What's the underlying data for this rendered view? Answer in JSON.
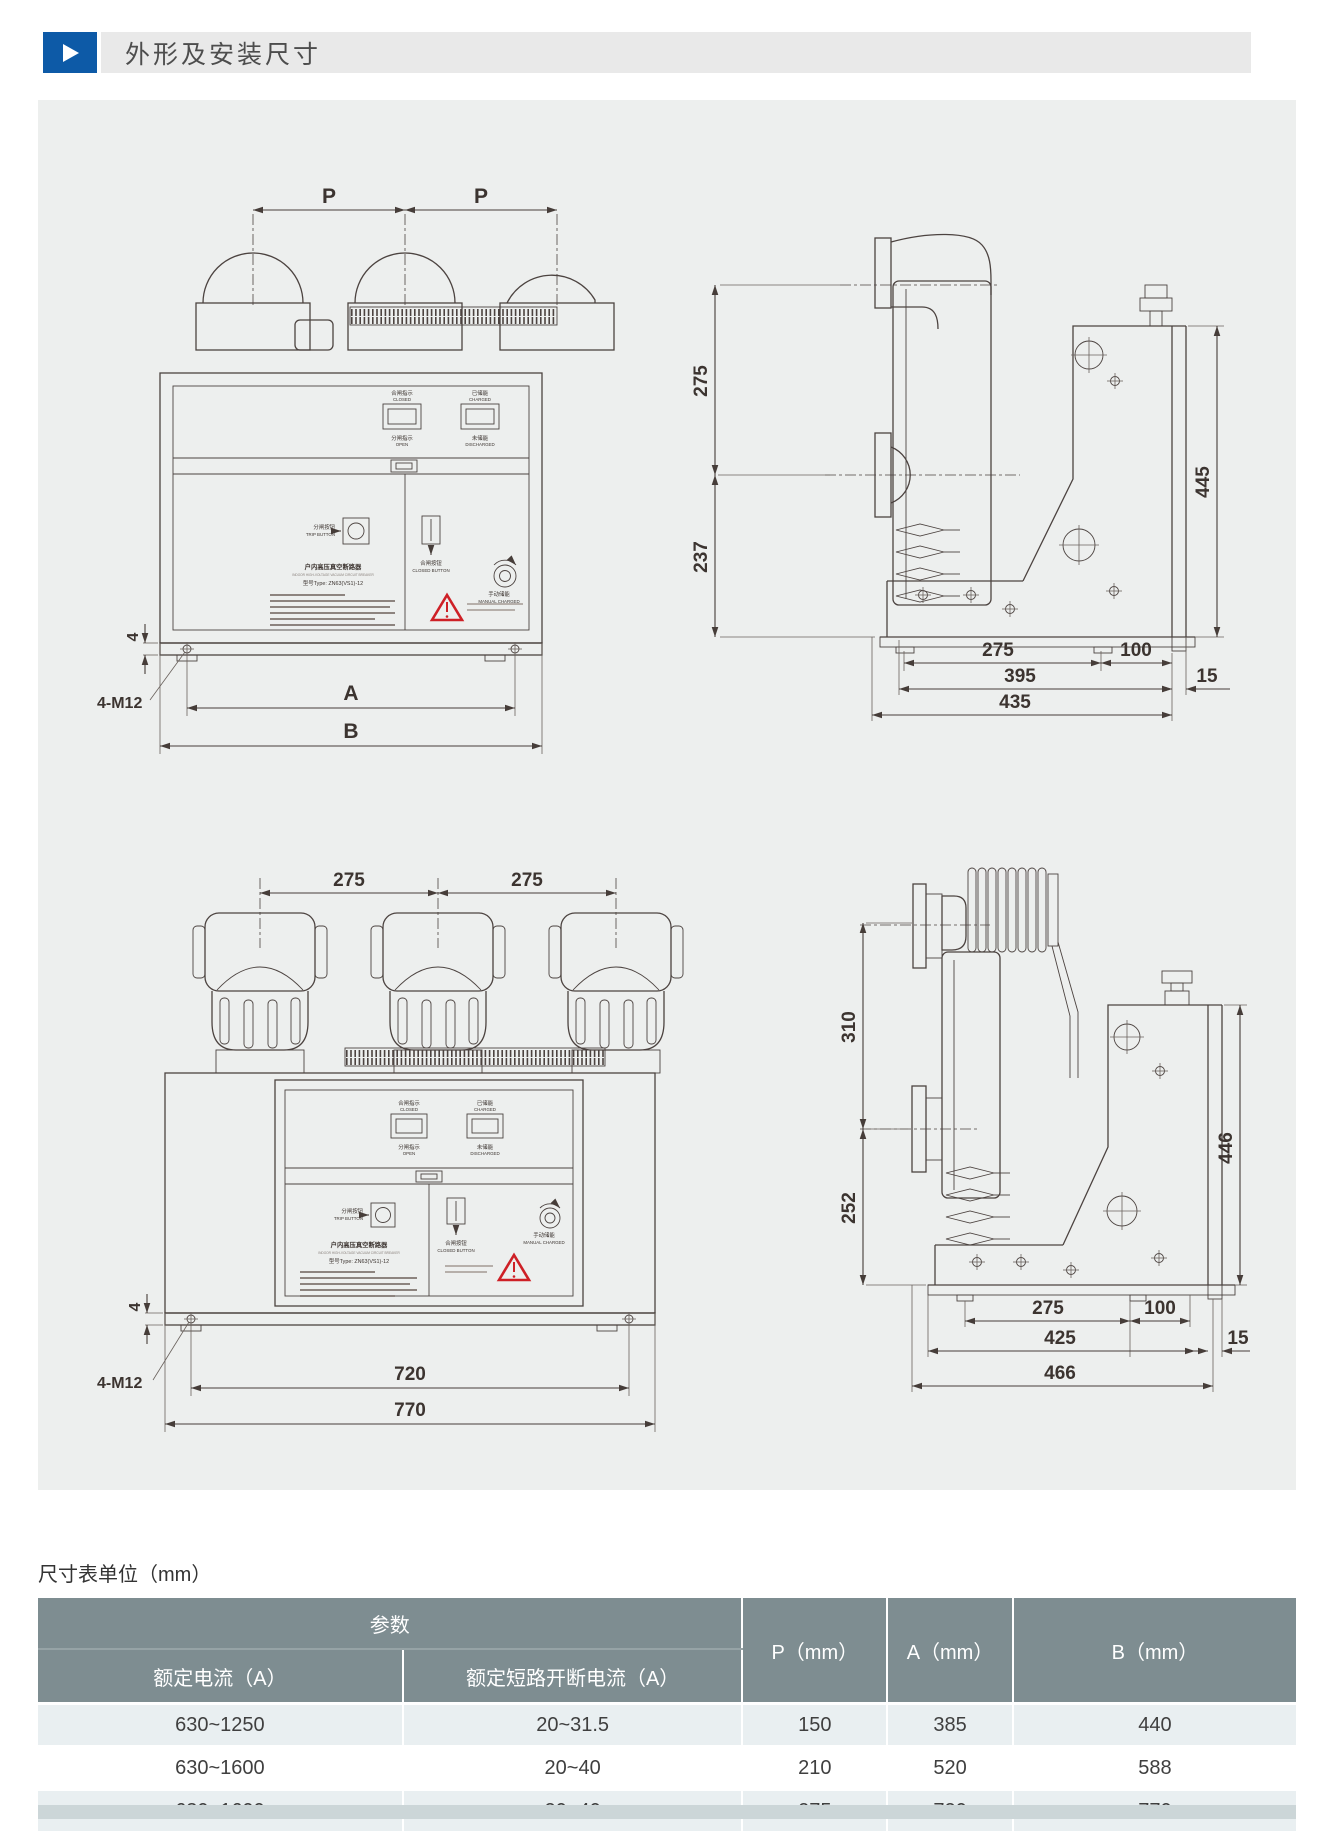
{
  "colors": {
    "accent_blue": "#0d5aa7",
    "title_bar_bg": "#e9e9e9",
    "panel_bg": "#edefee",
    "table_header_bg": "#7e8d91",
    "row_alt_bg": "#e9eff1",
    "warning_red": "#ce2026",
    "drawing_line": "#4c4340"
  },
  "header": {
    "title": "外形及安装尺寸"
  },
  "drawings": {
    "panel_labels": {
      "closed_cn": "合闸指示",
      "closed_en": "CLOSED",
      "charged_cn": "已储能",
      "charged_en": "CHARGED",
      "open_cn": "分闸指示",
      "open_en": "OPEN",
      "discharged_cn": "未储能",
      "discharged_en": "DISCHARGED",
      "trip_cn": "分闸按钮",
      "trip_en": "TRIP BUTTON",
      "close_cn": "合闸按钮",
      "close_en": "CLOSED BUTTON",
      "manual_cn": "手动储能",
      "manual_en": "MANUAL CHARGED",
      "nameplate_cn": "户内高压真空断路器",
      "nameplate_en": "INDOOR HIGH-VOLTAGE VACUUM CIRCUIT BREAKER",
      "nameplate_model": "型号Type: ZN63(VS1)-12"
    },
    "front_small": {
      "top_dim_left": "P",
      "top_dim_right": "P",
      "foot_dim": "4",
      "anchor_label": "4-M12",
      "bottom_dim_inner": "A",
      "bottom_dim_outer": "B"
    },
    "side_small": {
      "upper_left_dim": "275",
      "lower_left_dim": "237",
      "right_dim": "445",
      "bottom_row1": [
        "275",
        "100"
      ],
      "bottom_row2": [
        "395",
        "15"
      ],
      "bottom_row3": "435"
    },
    "front_large": {
      "top_dim_left": "275",
      "top_dim_right": "275",
      "foot_dim": "4",
      "anchor_label": "4-M12",
      "bottom_dim_inner": "720",
      "bottom_dim_outer": "770"
    },
    "side_large": {
      "upper_left_dim": "310",
      "lower_left_dim": "252",
      "right_dim": "446",
      "bottom_row1": [
        "275",
        "100"
      ],
      "bottom_row2": [
        "425",
        "15"
      ],
      "bottom_row3": "466"
    }
  },
  "table": {
    "unit_note": "尺寸表单位（mm）",
    "group_header": "参数",
    "sub_headers": [
      "额定电流（A）",
      "额定短路开断电流（A）"
    ],
    "value_headers": [
      "P（mm）",
      "A（mm）",
      "B（mm）"
    ],
    "rows": [
      [
        "630~1250",
        "20~31.5",
        "150",
        "385",
        "440"
      ],
      [
        "630~1600",
        "20~40",
        "210",
        "520",
        "588"
      ],
      [
        "630~1600",
        "20~40",
        "275",
        "720",
        "770"
      ]
    ]
  }
}
